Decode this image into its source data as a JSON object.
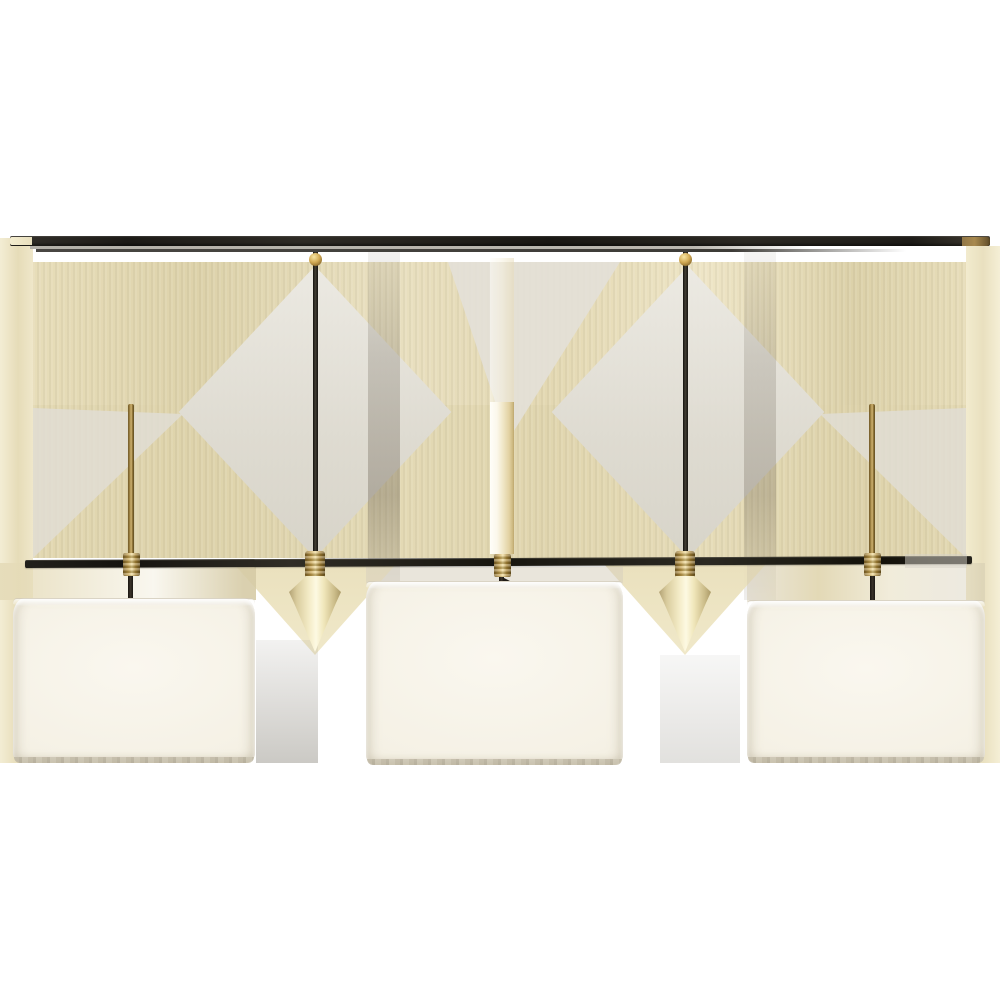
{
  "image": {
    "subject": "Three-light linear billiard chandelier with white drum shades, dark bronze rails and brass spear finials",
    "background": "#ffffff"
  },
  "fixture": {
    "shade_count": 3,
    "spear_finial_count": 2,
    "down_stem_count": 2,
    "support_rod_count": 3
  },
  "palette": {
    "bronze_rail_dark": "#1c1a16",
    "rail_reflection_gray": "#b4b1a9",
    "brass_mid": "#c6a24f",
    "brass_highlight": "#f0dc9c",
    "brass_shadow": "#66501f",
    "spear_cream": "#f3ebc6",
    "shade_linen_white": "#f5f1e5",
    "shade_rim_taupe": "#c9c2ae",
    "artifact_beige": "#e3d8b2",
    "artifact_pale_gray": "#dedbd2",
    "artifact_shadow_gray": "#8f887a"
  }
}
